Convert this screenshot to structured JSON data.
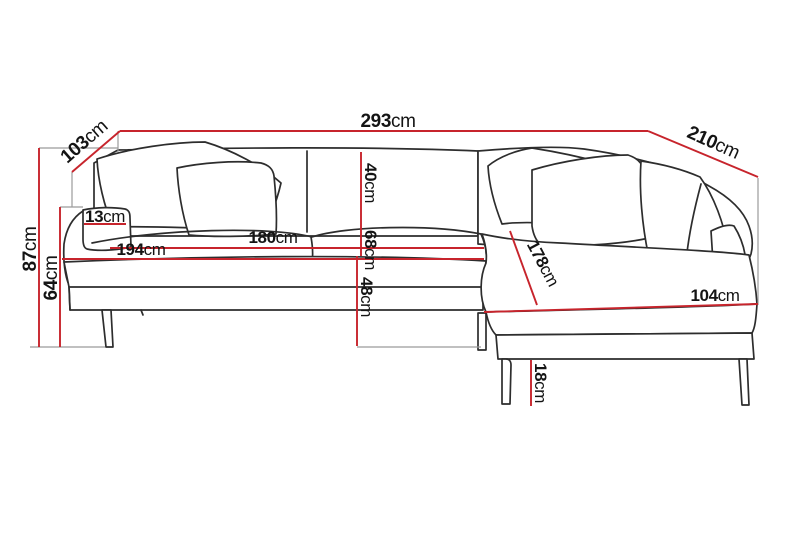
{
  "colors": {
    "dimension_line": "#c7242c",
    "sofa_outline": "#2d2d2d",
    "extension_line": "#9b9b9b",
    "label_text": "#141414",
    "background": "#ffffff"
  },
  "dimensions": {
    "total_width": {
      "value": "293",
      "unit": "cm"
    },
    "side_depth_left": {
      "value": "103",
      "unit": "cm"
    },
    "side_depth_right": {
      "value": "210",
      "unit": "cm"
    },
    "back_height": {
      "value": "87",
      "unit": "cm"
    },
    "arm_height": {
      "value": "64",
      "unit": "cm"
    },
    "arm_width": {
      "value": "13",
      "unit": "cm"
    },
    "seat_width_front": {
      "value": "194",
      "unit": "cm"
    },
    "seat_width_cushions": {
      "value": "180",
      "unit": "cm"
    },
    "backrest_height": {
      "value": "40",
      "unit": "cm"
    },
    "seat_back_height": {
      "value": "68",
      "unit": "cm"
    },
    "seat_height": {
      "value": "48",
      "unit": "cm"
    },
    "chaise_length": {
      "value": "178",
      "unit": "cm"
    },
    "chaise_width": {
      "value": "104",
      "unit": "cm"
    },
    "leg_height": {
      "value": "18",
      "unit": "cm"
    }
  }
}
